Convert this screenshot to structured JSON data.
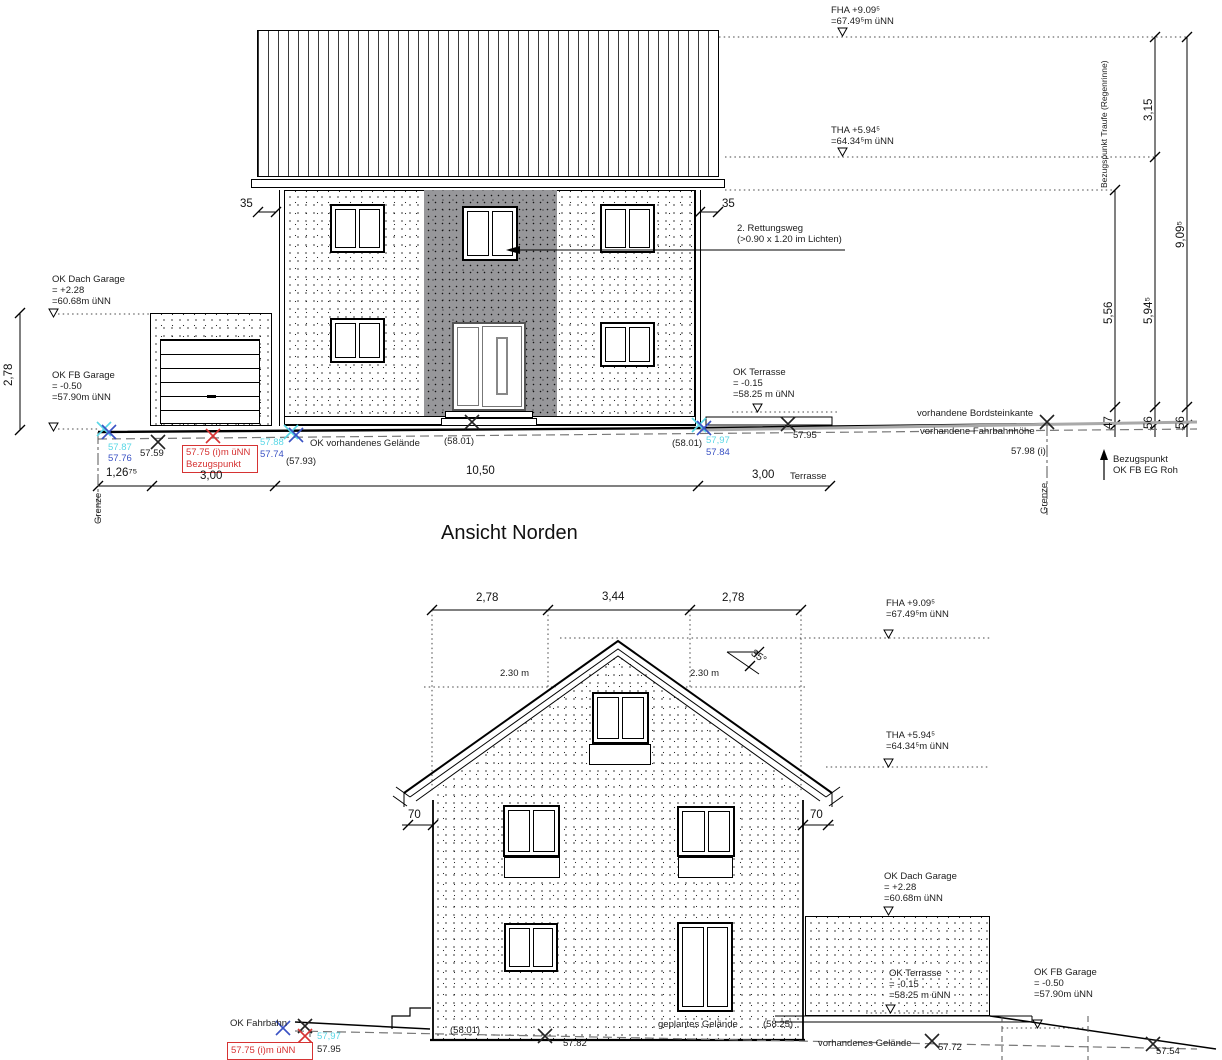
{
  "v1": {
    "title": "Ansicht Norden",
    "ann": {
      "fha1": "FHA +9.09⁵",
      "fha2": "=67.49⁵m üNN",
      "tha1": "THA +5.94⁵",
      "tha2": "=64.34⁵m üNN",
      "okdg1": "OK Dach Garage",
      "okdg2": "= +2.28",
      "okdg3": "=60.68m üNN",
      "okfbg1": "OK FB Garage",
      "okfbg2": "= -0.50",
      "okfbg3": "=57.90m üNN",
      "okterr1": "OK Terrasse",
      "okterr2": "= -0.15",
      "okterr3": "=58.25 m üNN",
      "rw1": "2. Rettungsweg",
      "rw2": "(>0.90 x 1.20 im Lichten)",
      "bordstein": "vorhandene Bordsteinkante",
      "fahrbahn": "vorhandene Fahrbahnhöhe",
      "okgel": "OK vorhandenes Gelände",
      "bztraufe": "Bezugspunkt Traufe (Regenrinne)",
      "bzeg1": "Bezugspunkt",
      "bzeg2": "OK FB EG Roh",
      "grenze_l": "Grenze",
      "grenze_r": "Grenze",
      "red1": "57.75 (i)m üNN",
      "red2": "Bezugspunkt"
    },
    "lv": {
      "c1": "57.87",
      "b1": "57.76",
      "k1": "57.59",
      "c2": "57.88",
      "b2": "57.74",
      "k2": "(57.93)",
      "k3": "(58.01)",
      "k4": "(58.01)",
      "c3": "57,97",
      "b3": "57.84",
      "k5": "57.95",
      "k6": "57.98 (i)"
    },
    "dim": {
      "d35l": "35",
      "d35r": "35",
      "d278": "2,78",
      "d126": "1,26⁷⁵",
      "d300a": "3,00",
      "d1050": "10,50",
      "d300b": "3,00",
      "terr": "Terrasse",
      "d315": "3,15",
      "d556": "5,56",
      "d594": "5,94⁵",
      "d909": "9,09⁵",
      "d47": "47",
      "d56a": "56",
      "d56b": "56"
    }
  },
  "v2": {
    "ann": {
      "fha1": "FHA +9.09⁵",
      "fha2": "=67.49⁵m üNN",
      "tha1": "THA +5.94⁵",
      "tha2": "=64.34⁵m üNN",
      "okdg1": "OK Dach Garage",
      "okdg2": "= +2.28",
      "okdg3": "=60.68m üNN",
      "okterr1": "OK Terrasse",
      "okterr2": "= -0.15",
      "okterr3": "=58.25 m üNN",
      "okfbg1": "OK FB Garage",
      "okfbg2": "= -0.50",
      "okfbg3": "=57.90m üNN",
      "okfahr": "OK Fahrbahn",
      "gepl": "geplantes Gelände",
      "vorh": "vorhandenes Gelände",
      "red1": "57.75 (i)m üNN"
    },
    "lv": {
      "c1": "57,97",
      "k0": "57.95",
      "k1": "57.82",
      "k2": "(58.01)",
      "k3": "(58.25)",
      "k4": "57.72",
      "k5": "57.54"
    },
    "dim": {
      "d278a": "2,78",
      "d344": "3,44",
      "d278b": "2,78",
      "d230a": "2.30 m",
      "d230b": "2.30 m",
      "ang": "35°",
      "d70a": "70",
      "d70b": "70"
    }
  },
  "colors": {
    "cyan": "#59d7e6",
    "blue": "#3a52c4",
    "red": "#d63333"
  }
}
